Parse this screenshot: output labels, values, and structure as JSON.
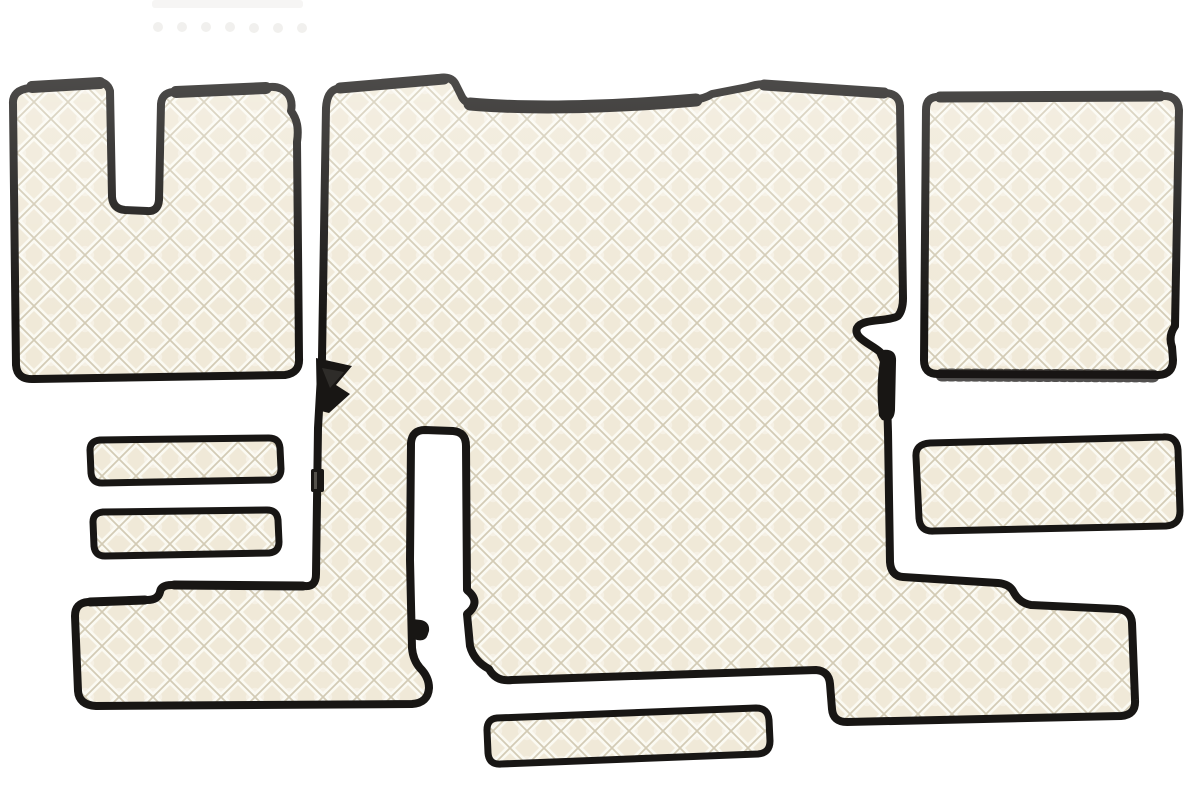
{
  "scene": {
    "type": "product-photo",
    "title": "Quilted truck floor mat set",
    "description": "Set of champagne/ivory diamond-quilted eco-leather truck cabin floor mats with black piped edges, arranged on a plain white background",
    "background_color": "#ffffff"
  },
  "colors": {
    "bg": "#ffffff",
    "quilt_base": "#f0e9d8",
    "quilt_shadow": "#cfc6ae",
    "quilt_highlight": "#fcfaf3",
    "trim": "#181614",
    "trim_soft": "#2e2c29",
    "faint_piece": "#f2f1ef",
    "faint_dot": "#ecebe7"
  },
  "pattern": {
    "type": "diamond-quilt",
    "diamond_pitch_px": 34,
    "trim_width_px": 8,
    "material": "quilted eco-leather"
  },
  "pieces": [
    {
      "id": "left-footwell-mat",
      "label": "Left footwell mat with seat-base cutout (top left)"
    },
    {
      "id": "center-tunnel-mat",
      "label": "Large one-piece engine tunnel and floor mat with side arm and lower wing (center)"
    },
    {
      "id": "right-footwell-mat",
      "label": "Right footwell mat, square (top right)"
    },
    {
      "id": "right-cover-strip",
      "label": "Wide cover strip (right middle)"
    },
    {
      "id": "left-sill-strip-upper",
      "label": "Narrow sill strip, upper (left middle)"
    },
    {
      "id": "left-sill-strip-lower",
      "label": "Narrow sill strip, lower (left middle)"
    },
    {
      "id": "bottom-step-strip",
      "label": "Narrow step strip (bottom center)"
    },
    {
      "id": "cropped-piece-top",
      "label": "Overexposed partially visible piece with snap fasteners at top edge"
    }
  ],
  "details": [
    {
      "id": "corner-flap-left",
      "label": "Folded black corner flap on left arm"
    },
    {
      "id": "side-tab-right",
      "label": "Black binding fold on right waist edge"
    },
    {
      "id": "hook-tab",
      "label": "Small black fastening tab inside channel"
    },
    {
      "id": "label-tag",
      "label": "Small dark product tag on left arm edge"
    }
  ]
}
